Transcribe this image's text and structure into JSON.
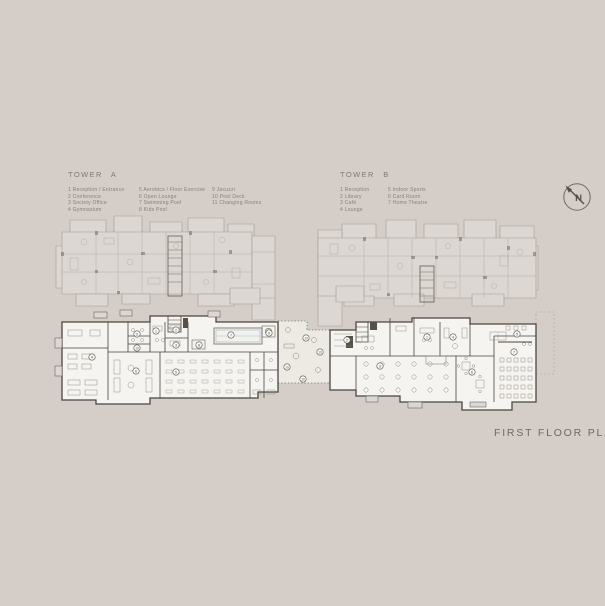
{
  "tower_a": {
    "title": "TOWER A",
    "legend_col1": [
      "1 Reception / Entrance",
      "2 Conference",
      "3 Society Office",
      "4 Gymnasium"
    ],
    "legend_col2": [
      "5 Aerobics / Floor Exercise",
      "6 Open Lounge",
      "7 Swimming Pool",
      "8 Kids Pool"
    ],
    "legend_col3": [
      "9 Jacuzzi",
      "10 Pool Deck",
      "11 Changing Rooms"
    ]
  },
  "tower_b": {
    "title": "TOWER B",
    "legend_col1": [
      "1 Reception",
      "2 Library",
      "3 Café",
      "4 Lounge"
    ],
    "legend_col2": [
      "5 Indoor Sports",
      "6 Card Room",
      "7 Home Theatre"
    ]
  },
  "compass": {
    "label": "N"
  },
  "caption": "FIRST FLOOR PLAN",
  "colors": {
    "background": "#d5cdc7",
    "ghost_line": "#a49c95",
    "ghost_fill": "#dcd7d2",
    "ghost_dark": "#6f6a63",
    "wall": "#4a4642",
    "floor_fill": "#f6f4f0",
    "deck_fill": "#edeae4",
    "furniture": "#8d867f",
    "legend_text": "#86807a",
    "caption_text": "#6e6964",
    "marker": "#5a554f"
  },
  "plan": {
    "markers": [
      {
        "tower": "A",
        "n": "1",
        "x": 156,
        "y": 331
      },
      {
        "tower": "A",
        "n": "2",
        "x": 176,
        "y": 330
      },
      {
        "tower": "A",
        "n": "3",
        "x": 176,
        "y": 345
      },
      {
        "tower": "A",
        "n": "4",
        "x": 92,
        "y": 357
      },
      {
        "tower": "A",
        "n": "5",
        "x": 176,
        "y": 372
      },
      {
        "tower": "A",
        "n": "6",
        "x": 136,
        "y": 371
      },
      {
        "tower": "A",
        "n": "7",
        "x": 231,
        "y": 335
      },
      {
        "tower": "A",
        "n": "8",
        "x": 199,
        "y": 345
      },
      {
        "tower": "A",
        "n": "9",
        "x": 269,
        "y": 333
      },
      {
        "tower": "A",
        "n": "11",
        "x": 137,
        "y": 334
      },
      {
        "tower": "A",
        "n": "10",
        "x": 137,
        "y": 348
      },
      {
        "tower": "deck",
        "n": "10",
        "x": 306,
        "y": 338
      },
      {
        "tower": "deck",
        "n": "10",
        "x": 320,
        "y": 352
      },
      {
        "tower": "deck",
        "n": "10",
        "x": 287,
        "y": 367
      },
      {
        "tower": "deck",
        "n": "10",
        "x": 303,
        "y": 379
      },
      {
        "tower": "B",
        "n": "1",
        "x": 427,
        "y": 337
      },
      {
        "tower": "B",
        "n": "2",
        "x": 347,
        "y": 340
      },
      {
        "tower": "B",
        "n": "3",
        "x": 380,
        "y": 366
      },
      {
        "tower": "B",
        "n": "4",
        "x": 453,
        "y": 337
      },
      {
        "tower": "B",
        "n": "5",
        "x": 517,
        "y": 334
      },
      {
        "tower": "B",
        "n": "6",
        "x": 472,
        "y": 372
      },
      {
        "tower": "B",
        "n": "7",
        "x": 514,
        "y": 352
      }
    ]
  }
}
